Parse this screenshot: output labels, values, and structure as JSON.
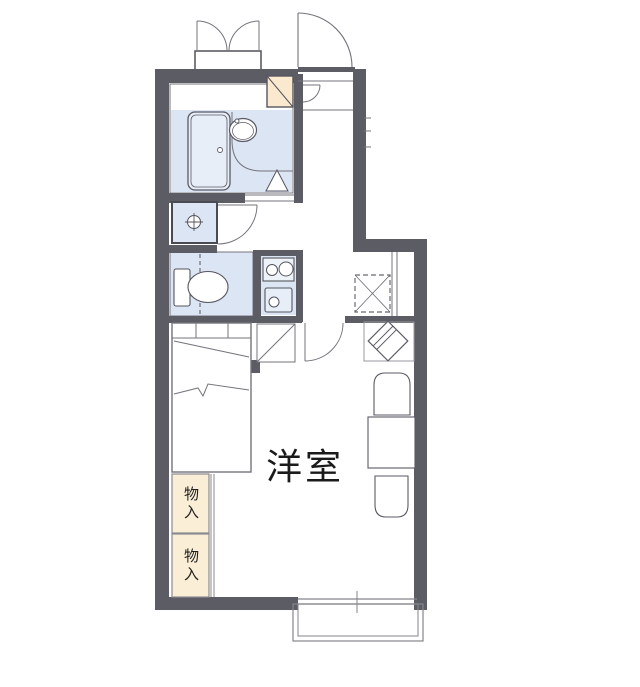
{
  "plan": {
    "labels": {
      "main_room": "洋室",
      "storage_top": "物入",
      "storage_bottom": "物入"
    },
    "rooms": [
      "unit-bathroom",
      "entrance-hall",
      "toilet-room",
      "kitchen",
      "western-style-room",
      "balcony"
    ],
    "fixtures": [
      "outdoor-double-door-storage-box",
      "entrance-door",
      "water-heater-box",
      "bathtub",
      "wash-basin",
      "bathroom-door-marker",
      "washing-machine-pan",
      "toilet",
      "two-burner-stove",
      "kitchen-sink",
      "refrigerator-space",
      "shoe-cabinet",
      "angled-side-table",
      "bed",
      "dining-table",
      "chair-top",
      "chair-bottom",
      "storage-closet-top",
      "storage-closet-bottom",
      "sliding-window",
      "balcony-railing"
    ],
    "colors": {
      "wall": "#5c5c64",
      "water_area_fill": "#dbe5f3",
      "fixture_fill": "#eef3fa",
      "storage_fill": "#fbeed6",
      "water_heater_fill": "#fae9cf",
      "line": "#73737c",
      "text": "#1a1a1a",
      "background": "#ffffff"
    }
  }
}
